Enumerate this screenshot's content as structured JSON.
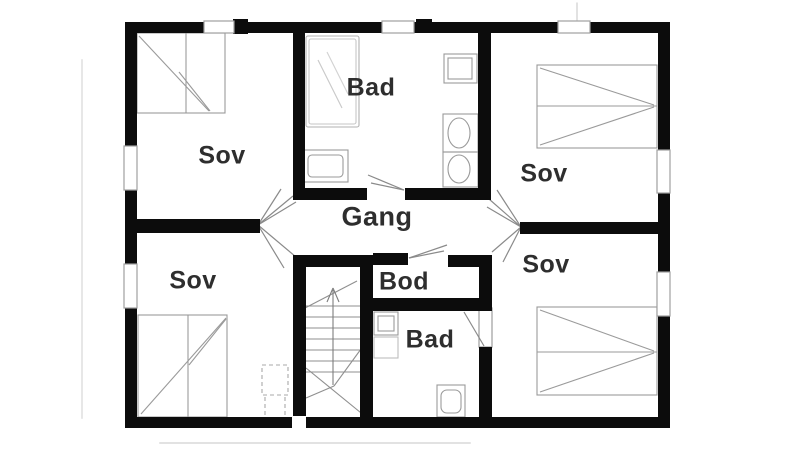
{
  "floorplan": {
    "rooms": [
      {
        "id": "sov-top-left",
        "label": "Sov"
      },
      {
        "id": "bad-top",
        "label": "Bad"
      },
      {
        "id": "sov-top-right",
        "label": "Sov"
      },
      {
        "id": "gang",
        "label": "Gang"
      },
      {
        "id": "sov-bottom-left",
        "label": "Sov"
      },
      {
        "id": "bod",
        "label": "Bod"
      },
      {
        "id": "bad-bottom",
        "label": "Bad"
      },
      {
        "id": "sov-bottom-right",
        "label": "Sov"
      }
    ],
    "fixtures": [
      "double-bed",
      "single-bed",
      "shower",
      "bathtub",
      "washbasin",
      "toilet",
      "sink-cabinet",
      "staircase-up-arrow",
      "door-swing",
      "window"
    ],
    "colors": {
      "wall": "#0c0c0c",
      "furniture_line": "#9a9a9a",
      "door_line": "#8a8a8a",
      "label_text": "#2e2e2e",
      "background": "#ffffff"
    }
  }
}
